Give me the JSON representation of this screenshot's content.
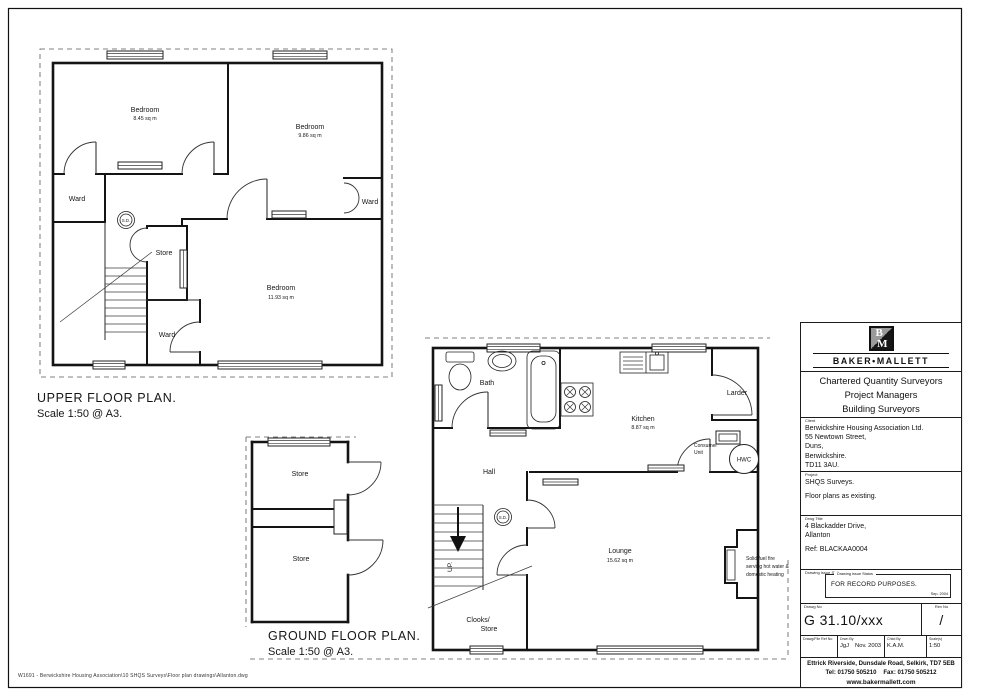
{
  "page": {
    "footer_path": "W1691 - Berwickshire Housing Association\\10 SHQS Surveys\\Floor plan drawings\\Allanton.dwg"
  },
  "upper_plan": {
    "title": "UPPER FLOOR  PLAN.",
    "scale": "Scale 1:50 @ A3.",
    "bedroom1_name": "Bedroom",
    "bedroom1_area": "8.45 sq m",
    "bedroom2_name": "Bedroom",
    "bedroom2_area": "9.86 sq m",
    "bedroom3_name": "Bedroom",
    "bedroom3_area": "11.93 sq m",
    "ward_left": "Ward",
    "ward_right": "Ward",
    "ward_bottom": "Ward",
    "store": "Store",
    "smoke_detector": "S.D."
  },
  "ground_plan": {
    "title": "GROUND FLOOR  PLAN.",
    "scale": "Scale 1:50 @ A3.",
    "bath": "Bath",
    "hall": "Hall",
    "larder": "Larder",
    "kitchen_name": "Kitchen",
    "kitchen_area": "8.87 sq m",
    "lounge_name": "Lounge",
    "lounge_area": "15.62 sq m",
    "store1": "Store",
    "store2": "Store",
    "cloaks_line1": "Clooks/",
    "cloaks_line2": "Store",
    "consumer_unit_line1": "Consumer",
    "consumer_unit_line2": "Unit",
    "hwc": "HWC",
    "up": "UP.",
    "smoke_detector": "S.D.",
    "fire_note_line1": "Solid fuel fire",
    "fire_note_line2": "serving hot water &",
    "fire_note_line3": "domestic heating"
  },
  "title_block": {
    "logo_b": "B",
    "logo_m": "M",
    "firm_name": "BAKER•MALLETT",
    "tagline1": "Chartered Quantity Surveyors",
    "tagline2": "Project Managers",
    "tagline3": "Building Surveyors",
    "client_label": "Client",
    "client": [
      "Berwickshire Housing Association Ltd.",
      "55 Newtown Street,",
      "Duns,",
      "Berwickshire.",
      "TD11 3AU."
    ],
    "project_label": "Project",
    "project": [
      "SHQS Surveys.",
      "Floor plans as existing."
    ],
    "drawing_title_label": "Drwg Title",
    "drawing_title": [
      "4 Blackadder Drive,",
      "Allanton",
      "Ref: BLACKAA0004"
    ],
    "status_label": "Drawing Issue Status",
    "status_text": "FOR RECORD PURPOSES.",
    "status_date": "Sep. 2004",
    "drawing_no_label": "Drawg No",
    "drawing_no": "G 31.10/xxx",
    "revision_label": "Rev No",
    "revision": "/",
    "file_ref_label": "Drawg/File Ref No",
    "file_ref": "",
    "drawn_by_label": "Drwn By",
    "drawn_by": "JgJ",
    "drawn_date": "Nov. 2003",
    "checked_by_label": "Chkd By",
    "checked_by": "K.A.M.",
    "scale_label": "Scale(s)",
    "scale_value": "1:50",
    "address": "Ettrick Riverside, Dunsdale Road, Selkirk, TD7 5EB",
    "tel": "Tel:  01750 505210",
    "fax": "Fax:  01750 505212",
    "website": "www.bakermallett.com"
  }
}
